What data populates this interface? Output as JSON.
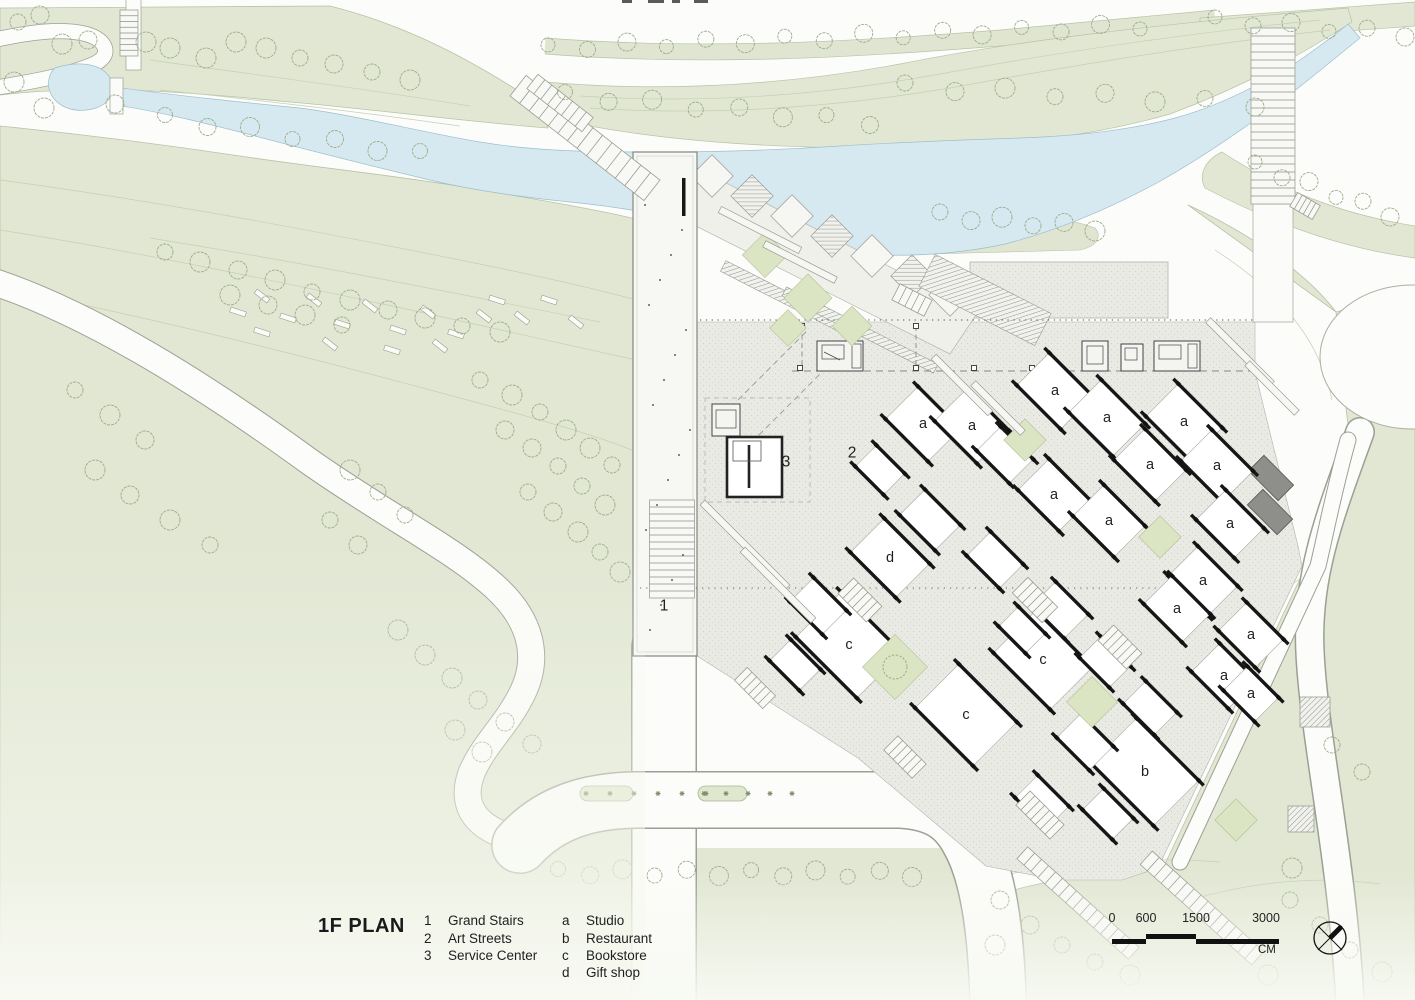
{
  "title": "1F PLAN",
  "legend": {
    "numbers": [
      {
        "key": "1",
        "label": "Grand Stairs"
      },
      {
        "key": "2",
        "label": "Art Streets"
      },
      {
        "key": "3",
        "label": "Service Center"
      }
    ],
    "letters": [
      {
        "key": "a",
        "label": "Studio"
      },
      {
        "key": "b",
        "label": "Restaurant"
      },
      {
        "key": "c",
        "label": "Bookstore"
      },
      {
        "key": "d",
        "label": "Gift shop"
      }
    ]
  },
  "scale_bar": {
    "ticks": [
      "0",
      "600",
      "1500",
      "3000"
    ],
    "unit": "CM"
  },
  "north_arrow": "compass-needle-pointing-north-east",
  "colors": {
    "landscape_green": "#e1e7d3",
    "courtyard_green": "#dbe5c4",
    "river_blue": "#d6e9f1",
    "plaza_gray": "#e9eae4",
    "wall_black": "#161616",
    "road_white": "#fcfcfa"
  },
  "plan_labels": [
    {
      "text": "1",
      "x": 664,
      "y": 606
    },
    {
      "text": "2",
      "x": 852,
      "y": 453
    },
    {
      "text": "3",
      "x": 786,
      "y": 462
    },
    {
      "text": "d",
      "x": 890,
      "y": 558
    },
    {
      "text": "a",
      "x": 923,
      "y": 424
    },
    {
      "text": "a",
      "x": 972,
      "y": 426
    },
    {
      "text": "a",
      "x": 1055,
      "y": 391
    },
    {
      "text": "a",
      "x": 1107,
      "y": 418
    },
    {
      "text": "a",
      "x": 1184,
      "y": 422
    },
    {
      "text": "a",
      "x": 1150,
      "y": 465
    },
    {
      "text": "a",
      "x": 1217,
      "y": 466
    },
    {
      "text": "a",
      "x": 1054,
      "y": 495
    },
    {
      "text": "a",
      "x": 1109,
      "y": 521
    },
    {
      "text": "a",
      "x": 1230,
      "y": 524
    },
    {
      "text": "a",
      "x": 1203,
      "y": 581
    },
    {
      "text": "a",
      "x": 1177,
      "y": 609
    },
    {
      "text": "a",
      "x": 1251,
      "y": 635
    },
    {
      "text": "a",
      "x": 1224,
      "y": 676
    },
    {
      "text": "a",
      "x": 1251,
      "y": 694
    },
    {
      "text": "c",
      "x": 849,
      "y": 645
    },
    {
      "text": "c",
      "x": 1043,
      "y": 660
    },
    {
      "text": "c",
      "x": 966,
      "y": 715
    },
    {
      "text": "b",
      "x": 1145,
      "y": 772
    }
  ]
}
